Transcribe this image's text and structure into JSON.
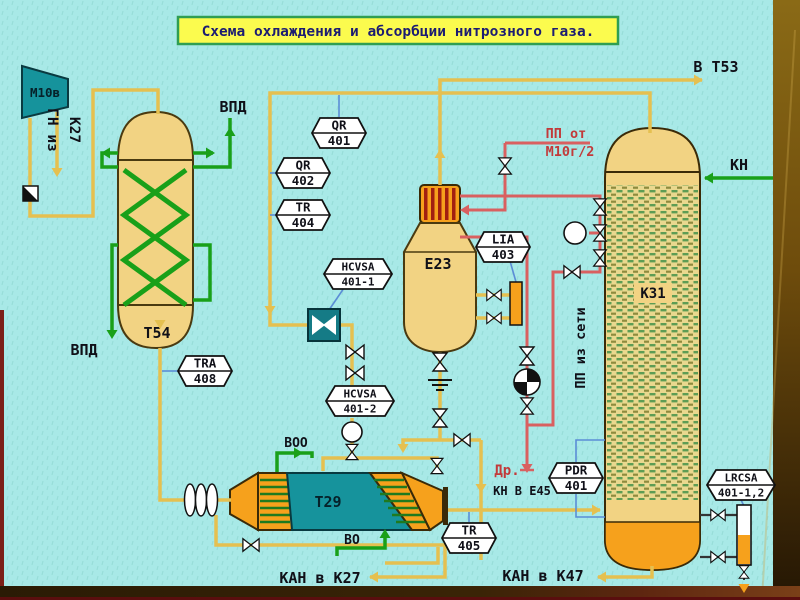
{
  "title": "Схема охлаждения и абсорбции нитрозного газа.",
  "equipment": {
    "compressor_label": "М10в",
    "t54_label": "Т54",
    "e23_label": "Е23",
    "k31_label": "К31",
    "t29_label": "Т29"
  },
  "instruments": {
    "qr401": {
      "line1": "QR",
      "line2": "401"
    },
    "qr402": {
      "line1": "QR",
      "line2": "402"
    },
    "tr404": {
      "line1": "TR",
      "line2": "404"
    },
    "tra408": {
      "line1": "TRA",
      "line2": "408"
    },
    "hcvsa1": {
      "line1": "HCVSA",
      "line2": "401-1"
    },
    "hcvsa2": {
      "line1": "HCVSA",
      "line2": "401-2"
    },
    "lia403": {
      "line1": "LIA",
      "line2": "403"
    },
    "pdr401": {
      "line1": "PDR",
      "line2": "401"
    },
    "tr405": {
      "line1": "TR",
      "line2": "405"
    },
    "lrcsa401": {
      "line1": "LRCSA",
      "line2": "401-1,2"
    }
  },
  "streams": {
    "gn_iz": "ГН из",
    "k27": "К27",
    "vpd_top": "ВПД",
    "vpd_left": "ВПД",
    "v_t53": "В Т53",
    "kn": "КН",
    "pp_ot": "ПП от",
    "m10g2": "М10г/2",
    "pp_iz_seti": "ПП из сети",
    "voo": "ВОО",
    "vo": "ВО",
    "kan_v_k27": "КАН в К27",
    "kan_v_k47": "КАН в К47",
    "dr": "Др.",
    "kn_v_e45": "КН В Е45"
  },
  "colors": {
    "background": "#a8e9e7",
    "title_bg": "#fbfb4e",
    "title_border": "#2f9e52",
    "title_text": "#1c1c72",
    "pipe_gas": "#e5c050",
    "pipe_water": "#19a019",
    "pipe_steam": "#d96060",
    "signal_line": "#5b8dd6",
    "vessel_tan": "#f2d383",
    "exchanger_teal": "#16939c",
    "accent_orange": "#f6a11c"
  }
}
